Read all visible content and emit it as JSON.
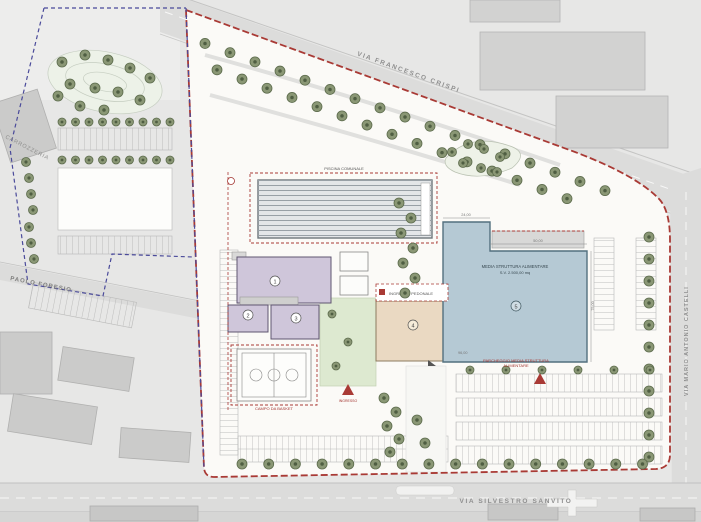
{
  "streets": {
    "top": "VIA FRANCESCO CRISPI",
    "bottom": "VIA SILVESTRO SANVITO",
    "right": "VIA MARIO ANTONIO CASTELLI",
    "left": "PAOLO FORESIO"
  },
  "context": {
    "building_label": "CARROZZERIA"
  },
  "site": {
    "pool_label": "PISCINA COMUNALE",
    "market_label1": "MEDIA STRUTTURA ALIMENTARE",
    "market_label2": "S.V. 2.500,00 mq",
    "basket_label": "CAMPO DA BASKET",
    "parking_label1": "PARCHEGGIO MEDIA STRUTTURA",
    "parking_label2": "ALIMENTARE",
    "entrance_label": "INGRESSO",
    "note_label": "INGRESSO PEDONALE",
    "numbers": {
      "hall": "1",
      "annex_left": "2",
      "annex_right": "3",
      "pavilion": "4",
      "market": "5"
    },
    "dims": {
      "d1": "24,00",
      "d2": "50,00",
      "d3": "75,00",
      "d4": "96,00"
    }
  },
  "colors": {
    "boundary_red": "#a93a35",
    "boundary_blue": "#4a4a9a",
    "market_fill": "#b5c9d4",
    "purple_fill": "#cfc6da",
    "tan_fill": "#ead9c2",
    "green_fill": "#dde9d0",
    "tree_fill": "#8a9775",
    "road_fill": "#dcdcdb"
  }
}
